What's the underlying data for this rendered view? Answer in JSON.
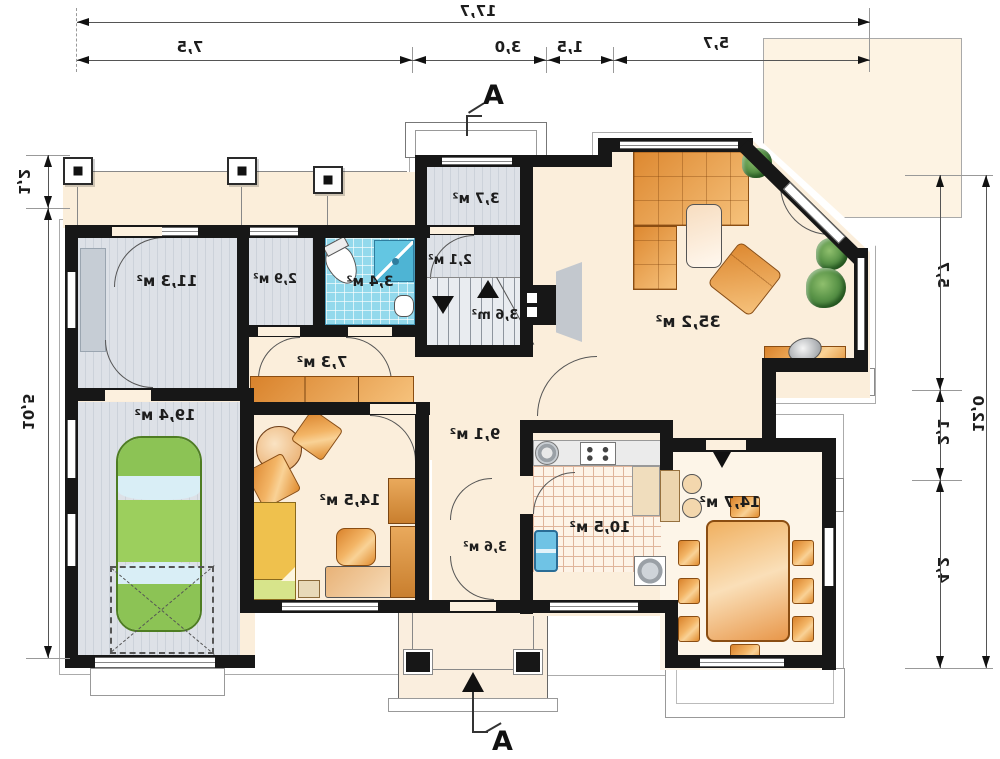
{
  "plan": {
    "section_marker": "A",
    "dimensions": {
      "top_total": "17,7",
      "top_segments": [
        "7,5",
        "3,0",
        "1,5",
        "5,7"
      ],
      "left_segments": [
        "1,2",
        "10,5"
      ],
      "right_segments": [
        "5,7",
        "2,1",
        "4,2"
      ],
      "right_total": "12,0"
    },
    "rooms": [
      {
        "name": "storage-room",
        "area": "11,3 м²"
      },
      {
        "name": "closet",
        "area": "2,9 м²"
      },
      {
        "name": "bathroom",
        "area": "3,4 м²"
      },
      {
        "name": "vestibule",
        "area": "3,7 м²"
      },
      {
        "name": "wc",
        "area": "2,1 м²"
      },
      {
        "name": "stairs",
        "area": "3,6 m²"
      },
      {
        "name": "hall",
        "area": "7,3 м²"
      },
      {
        "name": "living-room",
        "area": "35,2 м²"
      },
      {
        "name": "garage",
        "area": "19,4 м²"
      },
      {
        "name": "corridor",
        "area": "9,1 м²"
      },
      {
        "name": "bedroom",
        "area": "14,5 м²"
      },
      {
        "name": "rear-hall",
        "area": "3,6 м²"
      },
      {
        "name": "kitchen",
        "area": "10,5 м²"
      },
      {
        "name": "dining-room",
        "area": "14,7 м²"
      }
    ],
    "colors": {
      "wall": "#171717",
      "floor_cream": "#fbeedb",
      "floor_gray": "#d8dde3",
      "bath_tile_blue": "#93d9ec",
      "kitchen_tile_line": "#dfb49b",
      "furniture_orange": "#e08b33",
      "car_green": "#8cc355",
      "plant_green": "#2e6b2e",
      "bed_yellow": "#efc14d"
    }
  }
}
